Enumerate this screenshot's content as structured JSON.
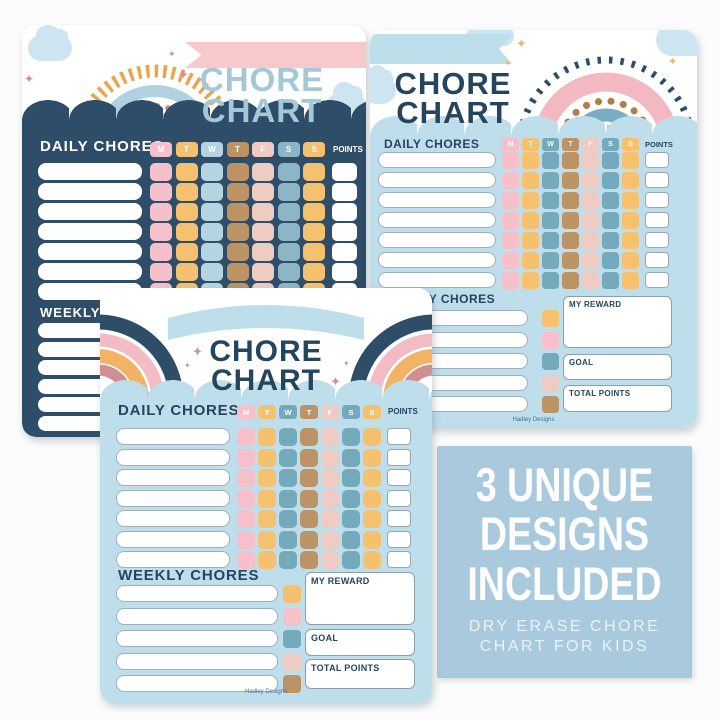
{
  "page": {
    "background": "#fcfcfc"
  },
  "days": [
    "M",
    "T",
    "W",
    "T",
    "F",
    "S",
    "S"
  ],
  "labels": {
    "title_line1": "CHORE",
    "title_line2": "CHART",
    "daily": "DAILY CHORES",
    "weekly": "WEEKLY CHORES",
    "points": "POINTS",
    "my_reward": "MY REWARD",
    "goal": "GOAL",
    "total_points": "TOTAL POINTS",
    "brand": "Hadley Designs"
  },
  "promo": {
    "line1": "3 UNIQUE",
    "line2": "DESIGNS",
    "line3": "INCLUDED",
    "sub_line1": "DRY ERASE CHORE",
    "sub_line2": "CHART FOR KIDS",
    "background": "#a9cadc",
    "text_color": "#ffffff"
  },
  "structure": {
    "chart_a": {
      "daily_rows": 7,
      "weekly_rows": 6
    },
    "chart_b": {
      "daily_rows": 7,
      "weekly_rows": 5
    },
    "chart_c": {
      "daily_rows": 7,
      "weekly_rows": 5
    }
  },
  "color_schemes": {
    "a": [
      "pink",
      "orange",
      "lightblue",
      "tan",
      "blush",
      "steel",
      "orange"
    ],
    "bc": [
      "pink",
      "orange",
      "teal",
      "tan",
      "blush",
      "teal",
      "orange"
    ],
    "side": [
      "orange",
      "pink",
      "teal",
      "blush",
      "tan"
    ]
  },
  "colors": {
    "navy": "#2d4d68",
    "navy_text": "#25455f",
    "panel_blue": "#bfdeec",
    "title_blue": "#a5c8d8",
    "ribbon_pink": "#f7c9cb",
    "cloud_blue": "#cde4f1",
    "cell_pink": "#f5c0ca",
    "cell_orange": "#f6c16e",
    "cell_lightblue": "#b3d4e0",
    "cell_teal": "#74aabc",
    "cell_tan": "#bb9364",
    "cell_blush": "#eeccc3",
    "cell_steel": "#8cb6c6"
  }
}
